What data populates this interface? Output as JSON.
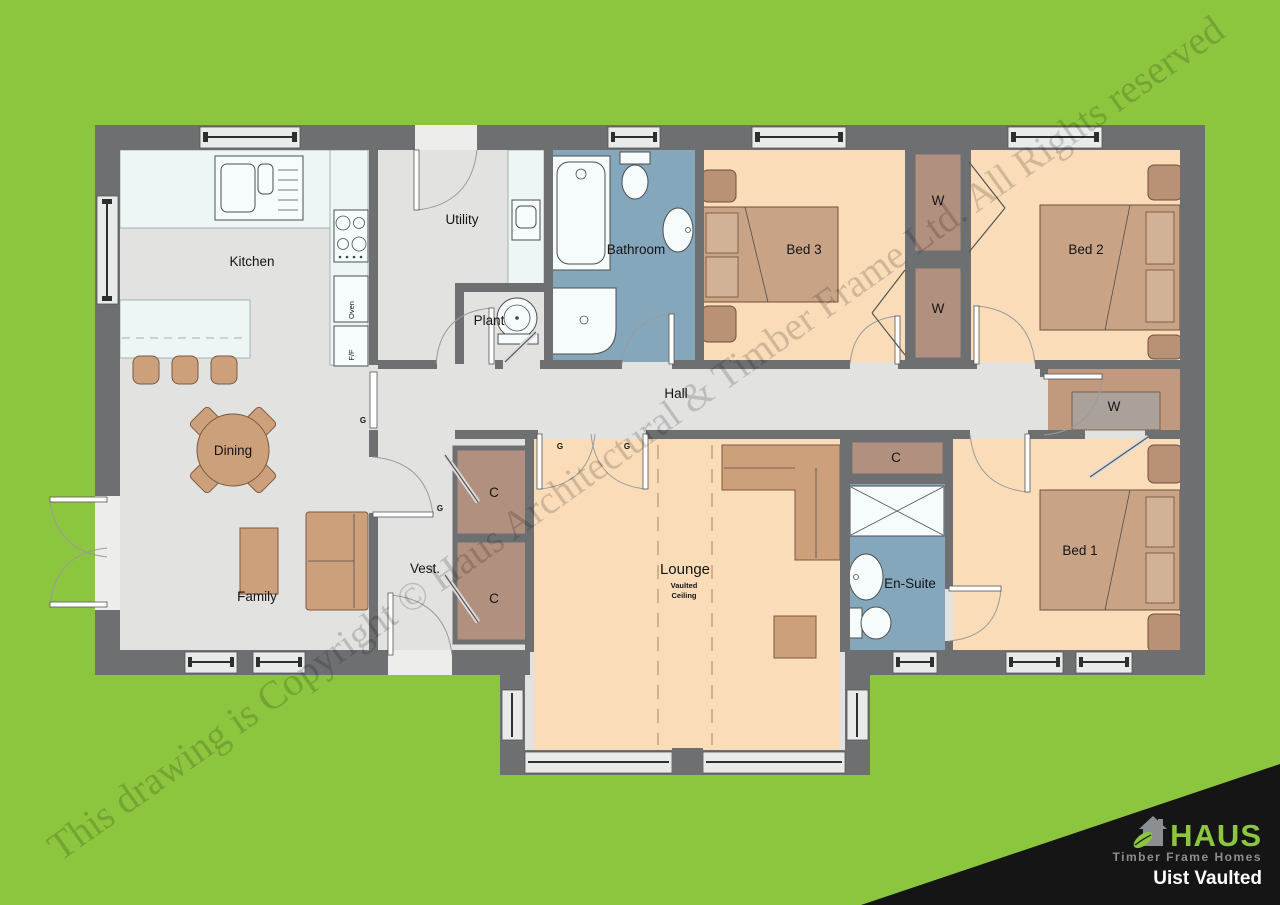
{
  "watermark": {
    "text": "This drawing is Copyright © Haus Architectural & Timber Frame Ltd. All Rights reserved"
  },
  "logo": {
    "brand": "HAUS",
    "tagline": "Timber Frame Homes",
    "plan_name": "Uist Vaulted"
  },
  "colors": {
    "background": "#8CC63E",
    "wall": "#6E6F71",
    "floor_gray": "#E2E2E1",
    "bedroom_floor": "#FADCB8",
    "bathroom_floor": "#84A7BC",
    "storage_floor": "#B29080",
    "walkin_floor": "#C1997E",
    "furniture": "#CDA07C",
    "logo_black": "#151515",
    "logo_gray": "#8A8F93"
  },
  "rooms": {
    "kitchen": "Kitchen",
    "utility": "Utility",
    "plant": "Plant",
    "bathroom": "Bathroom",
    "bed3": "Bed 3",
    "wardrobe1": "W",
    "wardrobe2": "W",
    "bed2": "Bed 2",
    "hall": "Hall",
    "walkin_wardrobe": "W",
    "cupboard1": "C",
    "dining": "Dining",
    "vestibule": "Vest.",
    "cupboard2": "C",
    "cupboard3": "C",
    "lounge": "Lounge",
    "lounge_sub1": "Vaulted",
    "lounge_sub2": "Ceiling",
    "ensuite": "En-Suite",
    "bed1": "Bed 1",
    "family": "Family"
  },
  "appliances": {
    "oven": "Oven",
    "fridge_freezer": "F/F"
  },
  "markers": {
    "glazed": "G"
  }
}
